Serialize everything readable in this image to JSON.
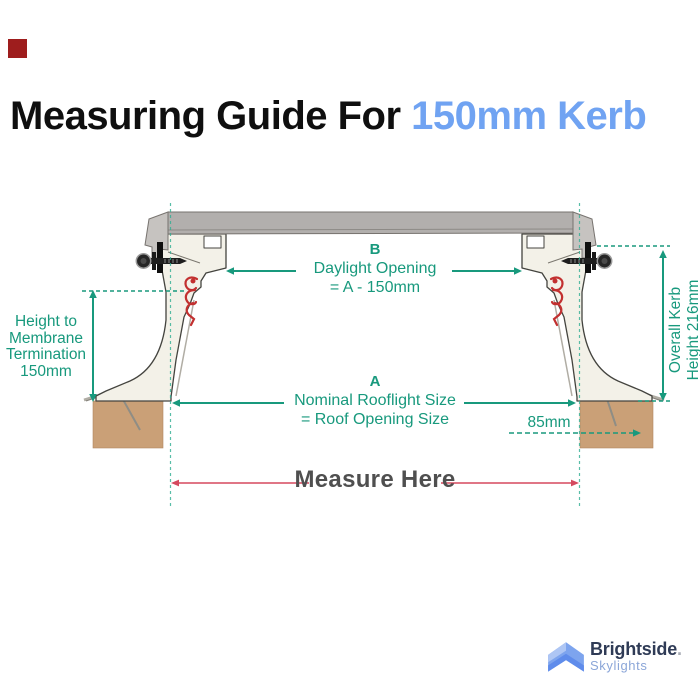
{
  "title": {
    "prefix": "Measuring Guide For ",
    "highlight": "150mm Kerb",
    "prefix_color": "#0f0f0f",
    "highlight_color": "#70a3f2"
  },
  "brand_square_color": "#9e1d1d",
  "diagram": {
    "colors": {
      "dimension_green": "#18997d",
      "dashed_ref_teal": "#2fae92",
      "measure_arrow_red": "#d5495f",
      "measure_text_gray": "#4f4f4f",
      "kerb_cream": "#f3f1e8",
      "glazing_gray": "#b2afad",
      "timber_brown": "#c89b70",
      "clip_red": "#c23030"
    },
    "labels": {
      "daylight": {
        "tag": "B",
        "lines": [
          "Daylight Opening",
          "= A - 150mm"
        ]
      },
      "rooflight": {
        "tag": "A",
        "lines": [
          "Nominal Rooflight Size",
          "= Roof Opening Size"
        ]
      },
      "membrane_height": {
        "lines": [
          "Height to",
          "Membrane",
          "Termination",
          "150mm"
        ]
      },
      "overall_kerb": {
        "lines": [
          "Overall Kerb",
          "Height 216mm"
        ]
      },
      "base_offset": "85mm",
      "measure_here": "Measure Here"
    }
  },
  "logo": {
    "icon": "roof-chevron-icon",
    "name": "Brightside",
    "dot": ".",
    "subtitle": "Skylights"
  }
}
